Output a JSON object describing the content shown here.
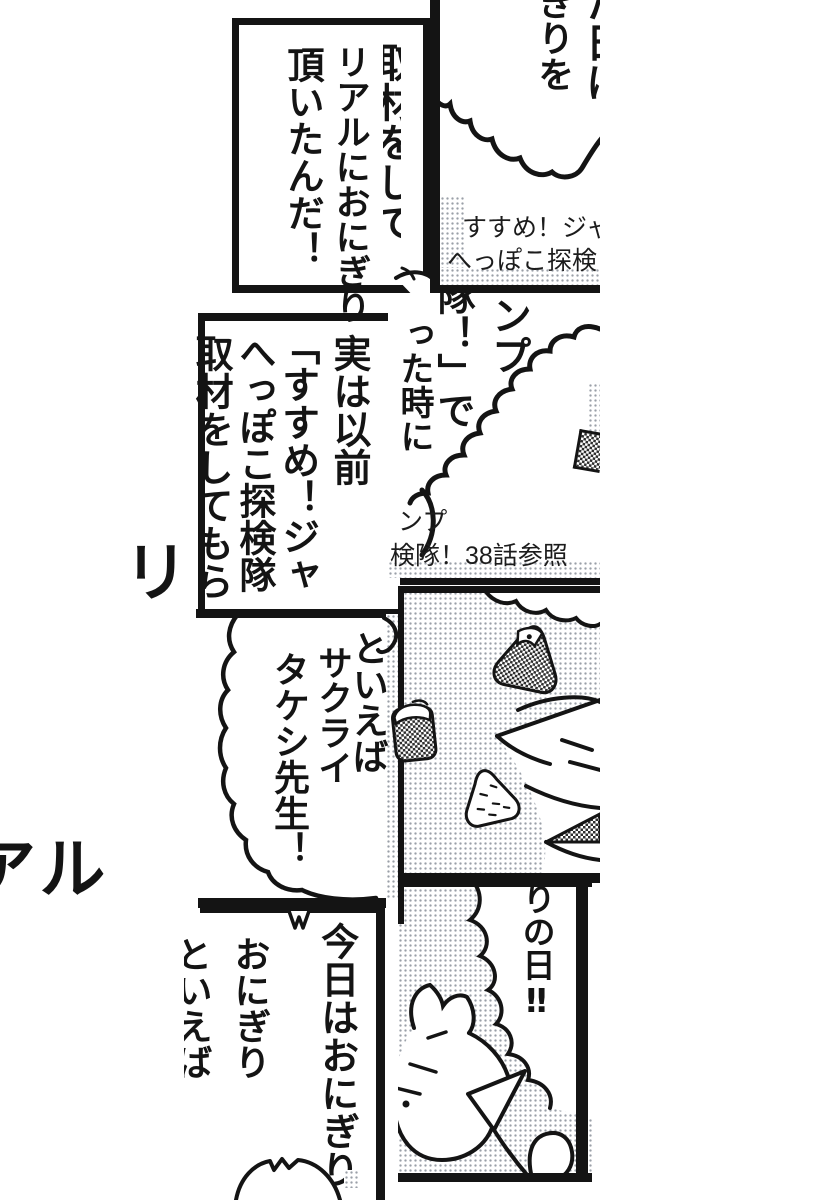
{
  "colors": {
    "ink": "#141414",
    "paper": "#ffffff",
    "halftone_dot": "#9aa0a8"
  },
  "background_title": {
    "fragment_top": "リ",
    "fragment_bottom": "アル"
  },
  "panels": {
    "top_left": {
      "clipped_column": "取材をして",
      "speech_col1": "リアルにおにぎり",
      "speech_col2": "頂いたんだ！"
    },
    "top_right": {
      "speech_col": "ぎりを",
      "clipped_column": "た日に",
      "caption_line1": "すすめ！ジャ",
      "caption_line2": "へっぽこ探検"
    },
    "mid_left": {
      "col1": "実は以前",
      "col2": "「すすめ！ジャ",
      "col3": "へっぽこ探検隊",
      "col4": "取材をしてもら"
    },
    "mid_right": {
      "col1": "ンプ",
      "col2": "隊！」で",
      "col3": "った時に",
      "caption_line1": "ンプ",
      "caption_line2": "検隊！38話参照"
    },
    "speech_left": {
      "col1": "といえば",
      "col2": "サクライ",
      "col3": "タケシ先生！"
    },
    "bottom_left": {
      "col1": "今日はおにぎり",
      "col2": "おにぎり",
      "clipped_column": "といえば"
    },
    "bottom_right": {
      "speech_col": "りの日‼"
    }
  }
}
